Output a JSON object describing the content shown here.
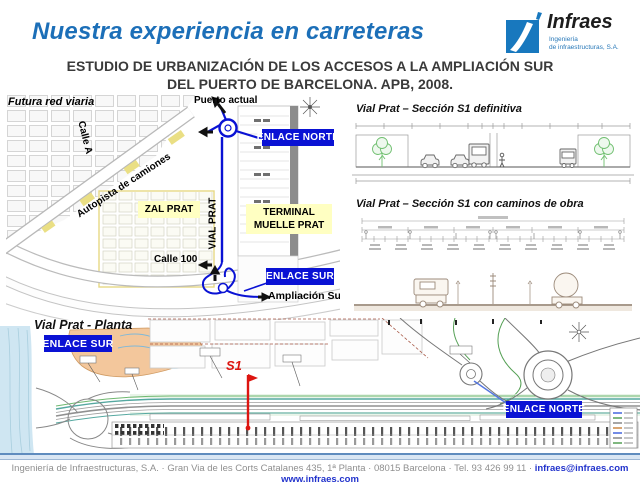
{
  "header": {
    "title": "Nuestra experiencia en carreteras",
    "logo": {
      "name": "Infraes",
      "tagline_line1": "Ingeniería",
      "tagline_line2": "de infraestructuras, S.A."
    },
    "subtitle_line1": "ESTUDIO DE URBANIZACIÓN DE LOS ACCESOS A LA AMPLIACIÓN SUR",
    "subtitle_line2": "DEL PUERTO DE BARCELONA. APB, 2008."
  },
  "map": {
    "labels": {
      "futura_red_viaria": "Futura red viaria",
      "calle_a": "Calle A",
      "autopista_camiones": "Autopista de camiones",
      "puerto_actual": "Puerto actual",
      "enlace_norte": "ENLACE NORTE",
      "zal_prat": "ZAL PRAT",
      "vial_prat": "VIAL PRAT",
      "terminal_muelle_prat": "TERMINAL MUELLE PRAT",
      "calle_100": "Calle 100",
      "enlace_sur": "ENLACE SUR",
      "ampliacion_sur": "Ampliación Sur"
    }
  },
  "sections": {
    "s1_definitiva_title": "Vial Prat – Sección S1 definitiva",
    "s1_obra_title": "Vial Prat – Sección S1 con caminos de obra"
  },
  "plan": {
    "title": "Vial Prat - Planta",
    "enlace_sur": "ENLACE SUR",
    "enlace_norte": "ENLACE NORTE",
    "s1_marker": "S1"
  },
  "footer": {
    "address": "Ingeniería de Infraestructuras, S.A. · Gran Via de les Corts Catalanes 435, 1ª Planta · 08015 Barcelona · Tel. 93 426 99 11 ·",
    "email": "infraes@infraes.com",
    "website": "www.infraes.com"
  },
  "colors": {
    "title_blue": "#1c6fb8",
    "enlace_blue": "#0a12d4",
    "label_yellow": "#ffffc2",
    "s1_red": "#dd1510",
    "link_blue": "#2233cc",
    "logo_blue": "#1878be"
  }
}
